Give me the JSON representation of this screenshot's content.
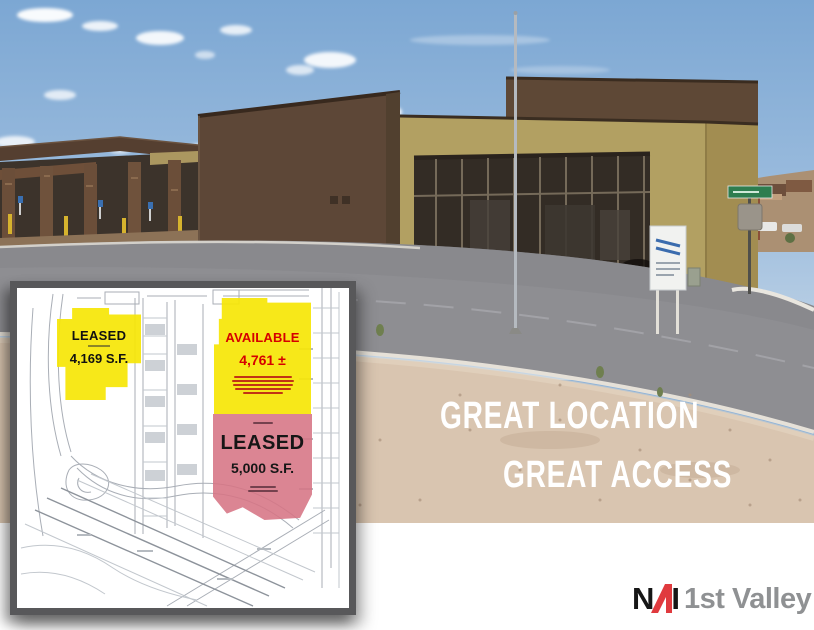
{
  "headline": {
    "line1": "GREAT LOCATION",
    "line2": "GREAT ACCESS"
  },
  "site_plan": {
    "suite_a": {
      "status": "LEASED",
      "area": "4,169 S.F."
    },
    "suite_b": {
      "status": "AVAILABLE",
      "area": "4,761 ±"
    },
    "suite_c": {
      "status": "LEASED",
      "area": "5,000 S.F."
    }
  },
  "logo": {
    "letter_n": "N",
    "letter_i": "I",
    "name": "1st Valley"
  },
  "colors": {
    "available_yellow": "#F6E608",
    "leased_pink": "#D67484",
    "available_text_red": "#D60000",
    "nai_red": "#E03A3E",
    "headline_white": "#FFFFFF",
    "logo_gray": "#8F9193"
  }
}
